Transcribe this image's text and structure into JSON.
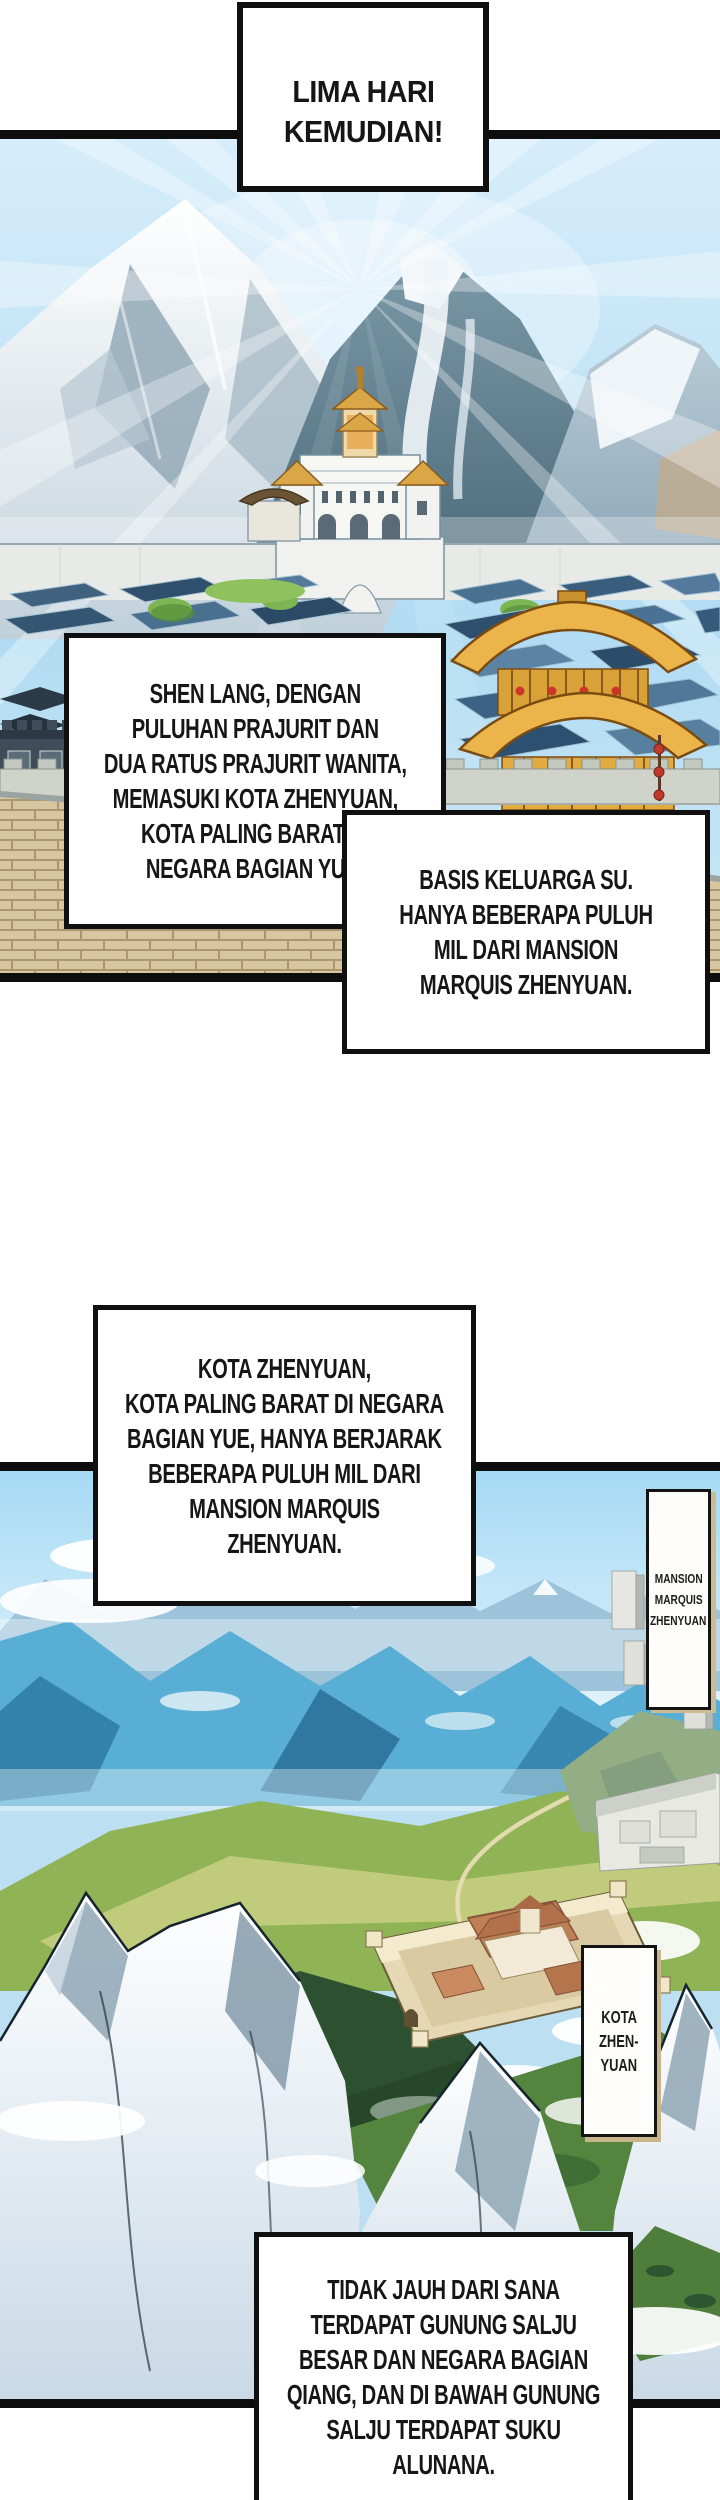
{
  "captions": {
    "time_skip": {
      "lines": [
        "LIMA HARI",
        "KEMUDIAN!"
      ]
    },
    "narration_1": {
      "lines": [
        "SHEN LANG, DENGAN",
        "PULUHAN PRAJURIT DAN",
        "DUA RATUS PRAJURIT WANITA,",
        "MEMASUKI KOTA ZHENYUAN,",
        "KOTA PALING BARAT DI",
        "NEGARA BAGIAN YUE!"
      ]
    },
    "narration_2": {
      "lines": [
        "BASIS KELUARGA SU.",
        "HANYA BEBERAPA PULUH",
        "MIL DARI MANSION",
        "MARQUIS ZHENYUAN."
      ]
    },
    "narration_3": {
      "lines": [
        "KOTA ZHENYUAN,",
        "KOTA PALING BARAT DI NEGARA",
        "BAGIAN YUE, HANYA BERJARAK",
        "BEBERAPA PULUH MIL DARI",
        "MANSION MARQUIS",
        "ZHENYUAN."
      ]
    },
    "narration_4": {
      "lines": [
        "TIDAK JAUH DARI SANA",
        "TERDAPAT GUNUNG SALJU",
        "BESAR DAN NEGARA BAGIAN",
        "QIANG, DAN DI BAWAH GUNUNG",
        "SALJU TERDAPAT SUKU",
        "ALUNANA."
      ]
    }
  },
  "labels": {
    "mansion_sign": {
      "lines": [
        "MANSION",
        "MARQUIS",
        "ZHENYUAN"
      ]
    },
    "kota_sign": {
      "lines": [
        "KOTA",
        "ZHEN-",
        "YUAN"
      ]
    }
  },
  "panels": {
    "panel_1_alt": "Snow mountain city of Zhenyuan with white palace and golden pagoda under sun rays",
    "panel_2_alt": "Aerial green valley with walled Kota Zhenyuan compound, gray mansion city and snowy peaks"
  },
  "colors": {
    "ink": "#101010",
    "paper": "#ffffff",
    "sky_panel1": "#c6e4f6",
    "sky_panel2": "#a5daf4",
    "gold_roof": "#ecb54c",
    "lantern_red": "#cc3528",
    "valley_green": "#69984a",
    "snow": "#f4f8fb",
    "sign_wood_edge": "#cdbb92"
  }
}
